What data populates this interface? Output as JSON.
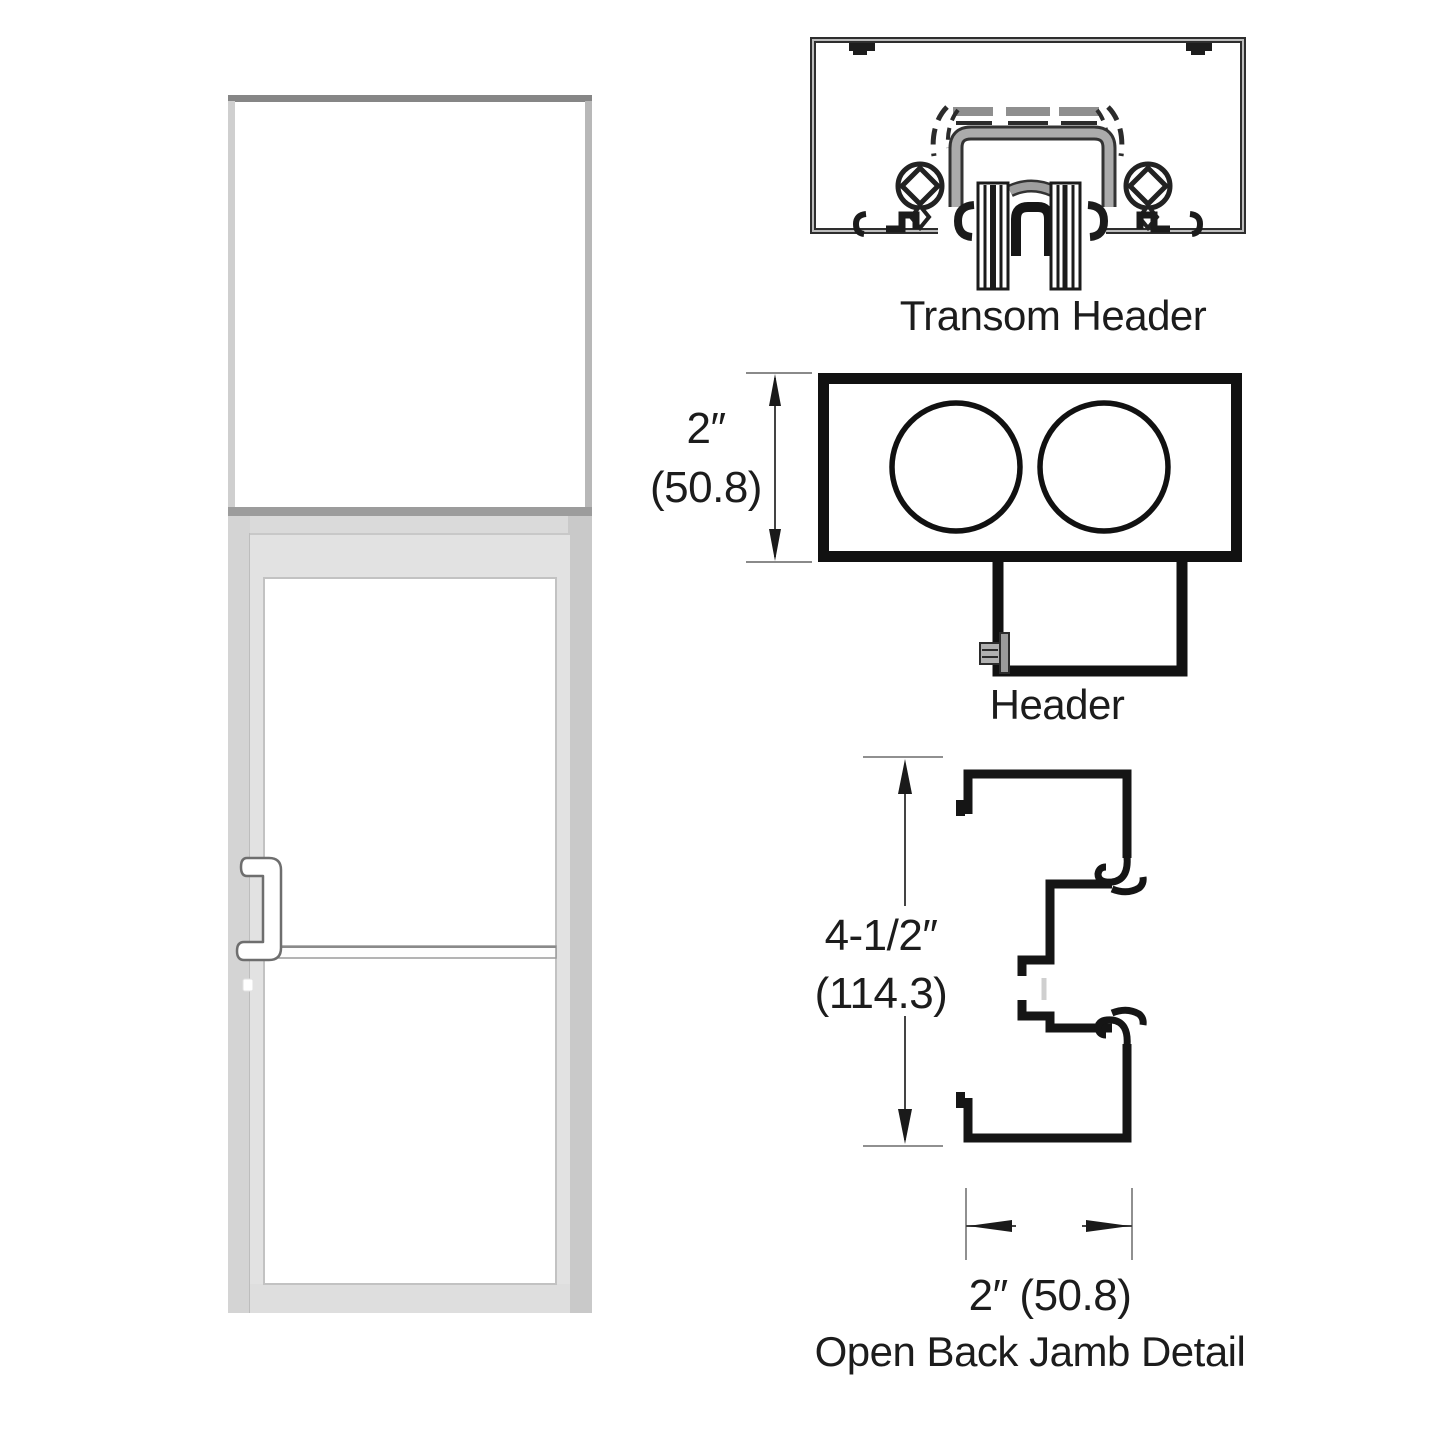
{
  "canvas": {
    "background": "#ffffff",
    "ink": "#1a1a1a",
    "frame_silver": "#d2d2d2"
  },
  "door_unit": {
    "frame_color": "#d2d2d2",
    "glass_color": "#ffffff"
  },
  "details": {
    "transom_header": {
      "label": "Transom Header"
    },
    "header": {
      "label": "Header",
      "dim_in": "2″",
      "dim_mm": "(50.8)"
    },
    "open_back_jamb": {
      "label": "Open Back Jamb Detail",
      "height_in": "4-1/2″",
      "height_mm": "(114.3)",
      "width": "2″ (50.8)"
    }
  }
}
